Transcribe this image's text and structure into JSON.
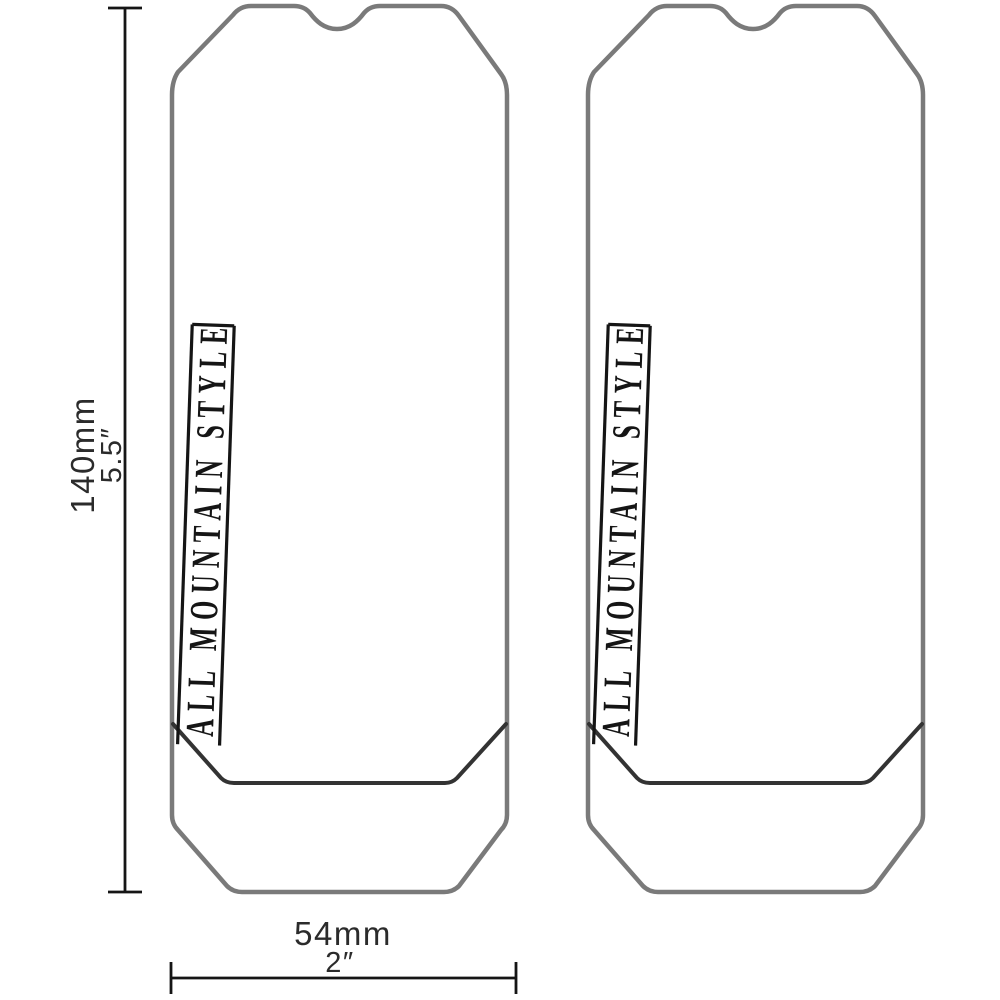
{
  "diagram": {
    "kind": "product-dimension-diagram",
    "subject": "fork crown protector decals (pair)"
  },
  "colors": {
    "background": "#ffffff",
    "outline": "#7a7a7a",
    "crease": "#333333",
    "ink": "#151515"
  },
  "dimensions": {
    "height": {
      "mm": "140mm",
      "inch": "5.5″"
    },
    "width": {
      "mm": "54mm",
      "inch": "2″"
    }
  },
  "shapes": [
    {
      "label": "ALL MOUNTAIN STYLE"
    },
    {
      "label": "ALL MOUNTAIN STYLE"
    }
  ]
}
